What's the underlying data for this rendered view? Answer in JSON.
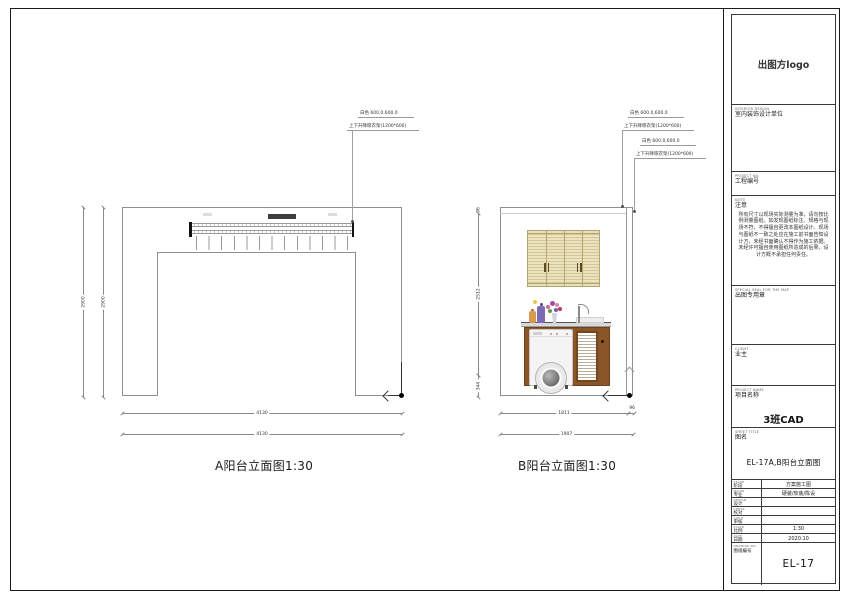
{
  "drawings": {
    "a_title": "A阳台立面图1:30",
    "b_title": "B阳台立面图1:30"
  },
  "annotations": {
    "line1": "白色 600.0,600.0",
    "line2": "上下升降晾衣架(1200*600)"
  },
  "dims": {
    "a_height_outer": "2900",
    "a_height_inner": "2900",
    "a_width_1": "4130",
    "a_width_2": "4130",
    "b_v_top": "96",
    "b_v_mid": "2512",
    "b_v_bot": "344",
    "b_w_left": "1811",
    "b_w_right": "96",
    "b_w_total": "1907"
  },
  "titleblock": {
    "logo": "出图方logo",
    "unit_en": "INTERIOR DESIGN",
    "unit_cn": "室内装饰设计单位",
    "projno_en": "PROJECT NO.",
    "projno_cn": "工程编号",
    "note_en": "NOTE",
    "note_cn": "注意",
    "note_text": "所有尺寸以现场实际测量为准，请勿按比例测量图纸。如发现图纸标注、规格与现场不符，不得擅自更改本图纸设计。现场与图纸不一致之处应在施工前书面告知设计方，未经书面确认不得作为施工依据。未经许可擅自使用图纸所造成的后果，设计方概不承担任何责任。",
    "seal_en": "SPECIAL SEAL FOR THE MAP",
    "seal_cn": "出图专用章",
    "client_en": "CLIENT",
    "client_cn": "业主",
    "projname_en": "PROJECT NAME",
    "projname_cn": "项目名称",
    "projname_value": "3班CAD",
    "sheettitle_en": "SHEET TITLE",
    "sheettitle_cn": "图名",
    "sheettitle_value": "EL-17A,B阳台立面图",
    "rows": [
      {
        "en": "STAGE",
        "cn": "阶段",
        "value": "方案施工图"
      },
      {
        "en": "MAJOR",
        "cn": "专业",
        "value": "硬装/软装/陈设"
      },
      {
        "en": "DESIGN",
        "cn": "设计",
        "value": ""
      },
      {
        "en": "CHECK",
        "cn": "校对",
        "value": ""
      },
      {
        "en": "AUDIT",
        "cn": "审核",
        "value": ""
      },
      {
        "en": "SCALE",
        "cn": "比例",
        "value": "1:30"
      },
      {
        "en": "DATE",
        "cn": "日期",
        "value": "2020.10"
      }
    ],
    "drawno_en": "DRAWING NO.",
    "drawno_cn": "图纸编号",
    "drawno_value": "EL-17"
  }
}
